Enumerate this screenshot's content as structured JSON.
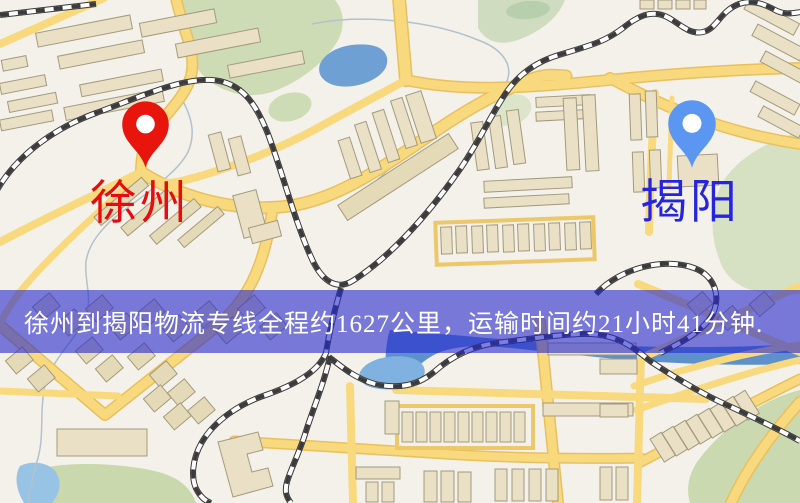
{
  "banner": {
    "text": "徐州到揭阳物流专线全程约1627公里，运输时间约21小时41分钟.",
    "background": "rgba(36,40,205,0.6)",
    "text_color": "#ffffff"
  },
  "origin": {
    "label": "徐州",
    "pin_color": "#e7150b",
    "label_color": "#e60d0d"
  },
  "destination": {
    "label": "揭阳",
    "pin_color": "#5b97f1",
    "label_color": "#2525dd"
  },
  "map_colors": {
    "background": "#f4f1ea",
    "road_fill": "#f8d97d",
    "road_casing": "#e9c05f",
    "building_fill": "#eae0c5",
    "building_stroke": "#a39a7d",
    "park_green": "#cddcb4",
    "water_blue": "#6fa0d4",
    "railway_dark": "#3b3b3b"
  }
}
